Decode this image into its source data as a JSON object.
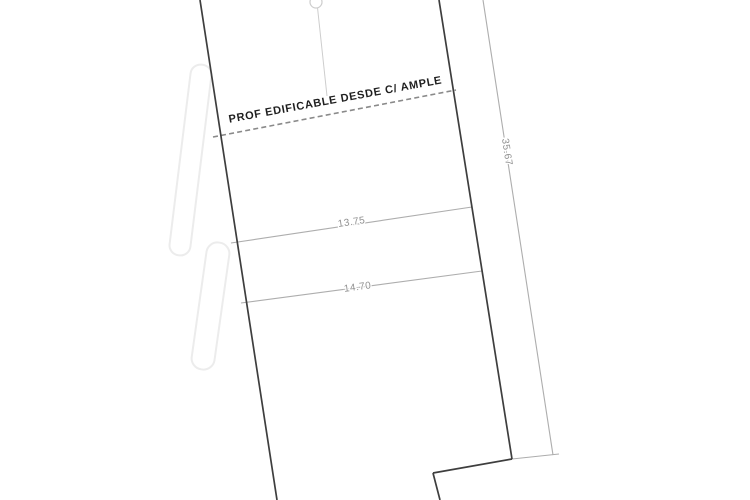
{
  "drawing": {
    "buildable_depth": {
      "label": "PROF EDIFICABLE DESDE C/ AMPLE"
    },
    "dimensions": {
      "upper_width": "13.75",
      "lower_width": "14.70",
      "right_depth": "35.67"
    },
    "colors": {
      "background": "#ffffff",
      "boundary": "#3e3e3e",
      "dimension": "#adadad",
      "dimension_text": "#8f8f8f",
      "dashed": "#8a8a8a",
      "label_text": "#1f1f1f",
      "faint": "#cdcdcd",
      "vegetation": "#ececec"
    }
  }
}
